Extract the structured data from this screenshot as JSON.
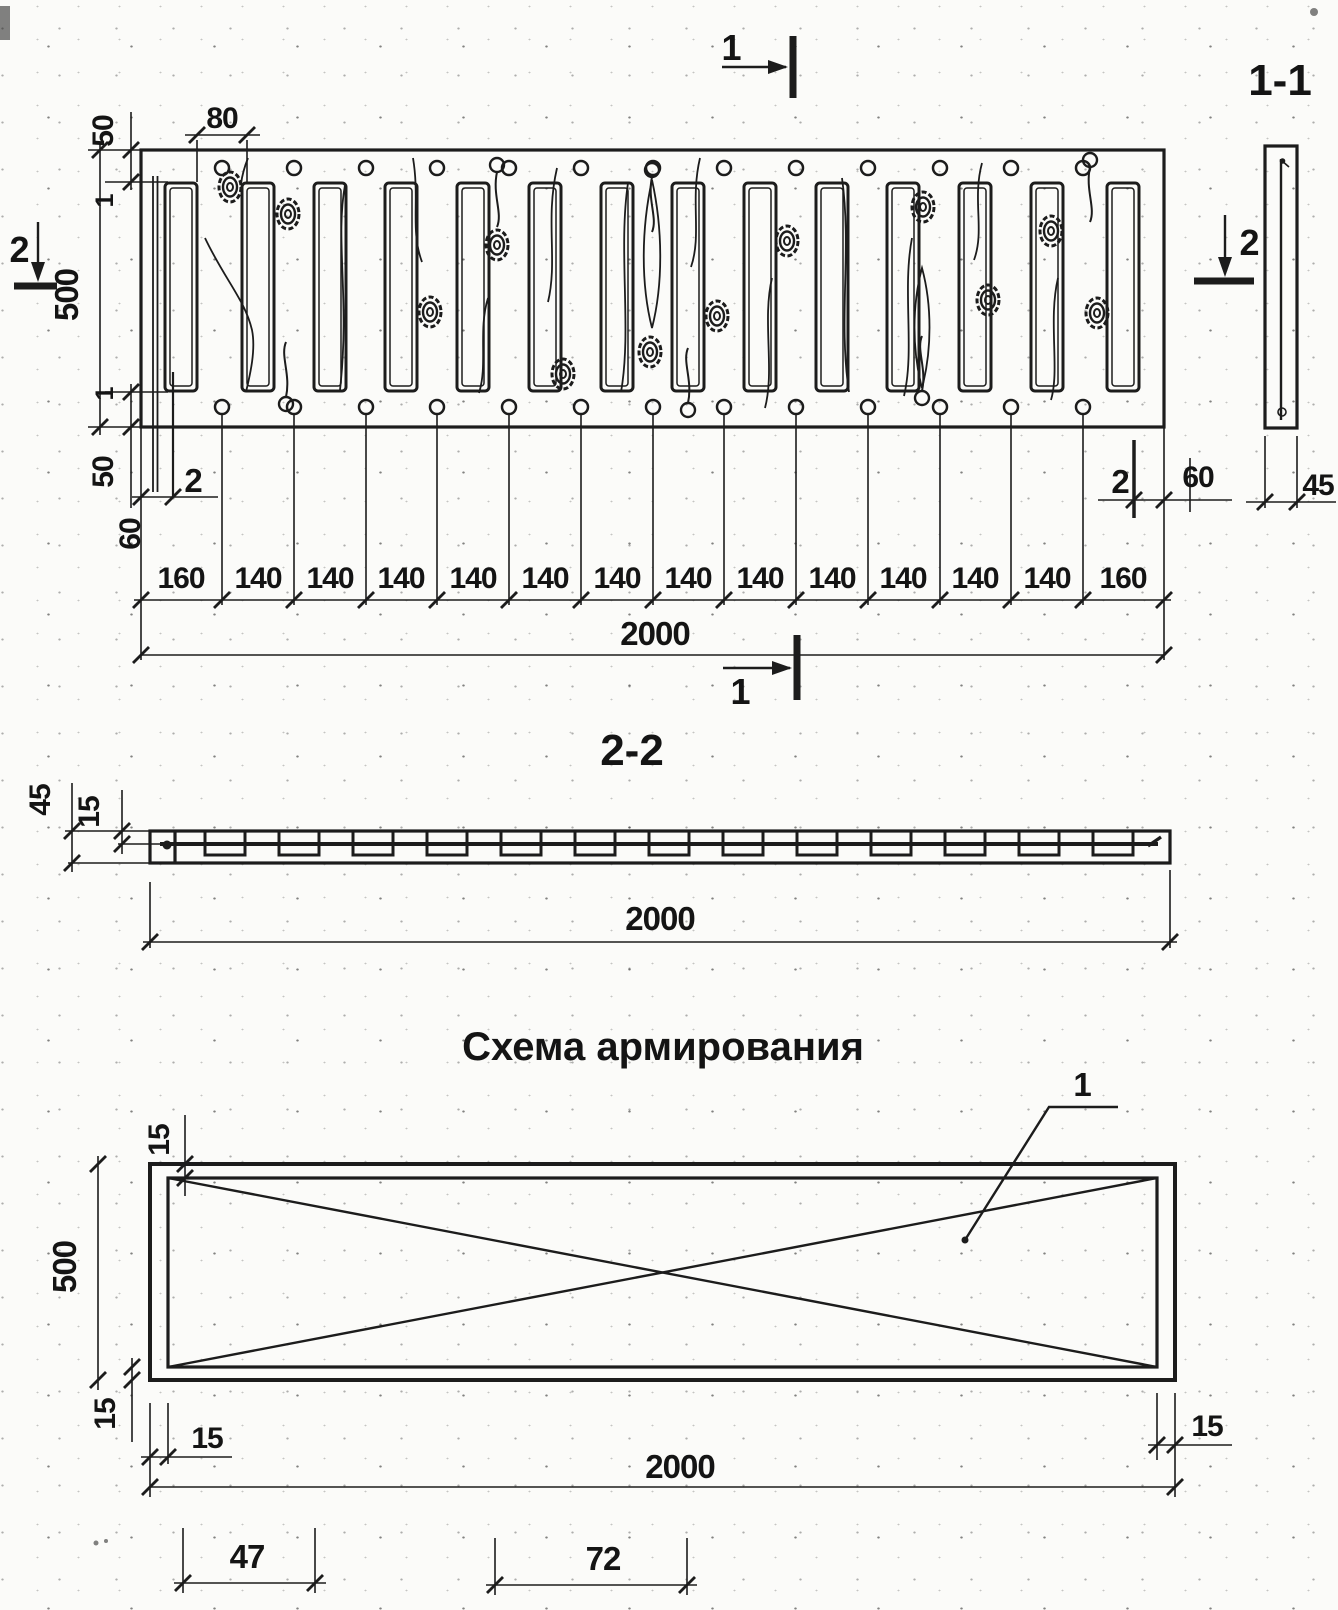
{
  "plan": {
    "marker_top": "1",
    "marker_bottom": "1",
    "marker_left": "2",
    "marker_right": "2",
    "dims": {
      "d80": "80",
      "d50_top": "50",
      "d1_top": "1",
      "d500": "500",
      "d1_bottom": "1",
      "d50_bottom": "50",
      "callout2_left": "2",
      "d60_left": "60",
      "callout2_right": "2",
      "d60_right": "60",
      "segments": [
        "160",
        "140",
        "140",
        "140",
        "140",
        "140",
        "140",
        "140",
        "140",
        "140",
        "140",
        "140",
        "140",
        "160"
      ],
      "total": "2000"
    }
  },
  "section11": {
    "title": "1-1",
    "d45": "45"
  },
  "section22": {
    "title": "2-2",
    "d45": "45",
    "d15": "15",
    "total": "2000"
  },
  "scheme": {
    "title": "Схема армирования",
    "bar_label": "1",
    "d15_top": "15",
    "d500": "500",
    "d15_bottom": "15",
    "d15_left": "15",
    "d15_right": "15",
    "total": "2000",
    "d47": "47",
    "d72": "72"
  }
}
